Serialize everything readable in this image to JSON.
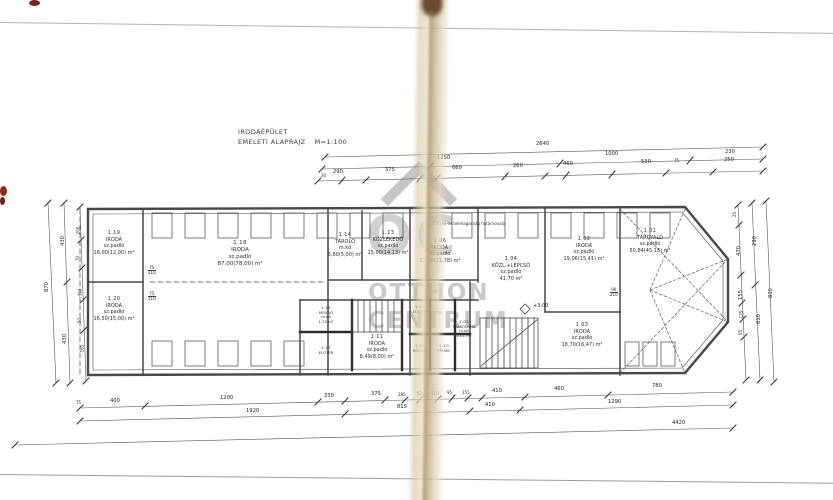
{
  "sheet": {
    "background": "#ffffff",
    "ink": "#474747",
    "crease_color": "#d5c5a6",
    "stain_color": "#7a241c",
    "watermark_color": "#c9c9c9"
  },
  "title": {
    "line1": "IRODAÉPÜLET",
    "line2": "EMELETI ALAPRAJZ",
    "scale": "M=1:100"
  },
  "watermark": {
    "logo": "OC",
    "line1": "OTTHON",
    "line2": "CENTRUM"
  },
  "plan": {
    "note": "1,90 m-es belmagasság határvonala",
    "level_mark": "+3,00",
    "door_marks": [
      {
        "w": "75",
        "h": "210"
      },
      {
        "w": "75",
        "h": "210"
      },
      {
        "w": "90",
        "h": "210"
      }
    ],
    "rooms": [
      {
        "number": "1.19",
        "name": "IRODA",
        "spec": "sz.padló",
        "area": "16,00(12,00) m²"
      },
      {
        "number": "1.20",
        "name": "IRODA",
        "spec": "sz.padló",
        "area": "16,50(15,00) m²"
      },
      {
        "number": "1.18",
        "name": "IRODA",
        "spec": "sz.padló",
        "area": "87,00(78,00) m²"
      },
      {
        "number": "1.14",
        "name": "TÁROLÓ",
        "spec": "m.kő",
        "area": "6,60(5,00) m²"
      },
      {
        "number": "1.13",
        "name": "KÖZLEKEDŐ",
        "spec": "sz.padló",
        "area": "15,00(14,13) m²"
      },
      {
        "number": "1.06",
        "name": "IRODA",
        "spec": "sz.padló",
        "area": "23,36(21,78) m²"
      },
      {
        "number": "1.04",
        "name": "KÖZL.+LÉPCSŐ",
        "spec": "sz.padló",
        "area": "41,70 m²"
      },
      {
        "number": "1.02",
        "name": "IRODA",
        "spec": "sz.padló",
        "area": "19,06(15,41) m²"
      },
      {
        "number": "1.01",
        "name": "TÁRGYALÓ",
        "spec": "sz.padló",
        "area": "50,84(45,15) m²"
      },
      {
        "number": "1.03",
        "name": "IRODA",
        "spec": "sz.padló",
        "area": "18,70(16,47) m²"
      },
      {
        "number": "1.11",
        "name": "IRODA",
        "spec": "sz.padló",
        "area": "8,49(8,00) m²"
      },
      {
        "number": "1.12",
        "name": "MOSDÓ",
        "spec": "m.kő",
        "area": "1,70 m²"
      },
      {
        "number": "1.05",
        "name": "TEAKONYHA",
        "spec": "m.kő",
        "area": "6,61 m²"
      },
      {
        "number": "1.07",
        "name": "ELŐTÉR",
        "spec": "m.kő",
        "area": ""
      },
      {
        "number": "1.09",
        "name": "NŐI WC",
        "spec": "m.kő",
        "area": ""
      },
      {
        "number": "1.10",
        "name": "FFI WC",
        "spec": "m.kő",
        "area": ""
      },
      {
        "number": "1.17",
        "name": "ELŐTÉR",
        "spec": "m.kő",
        "area": ""
      }
    ]
  },
  "dimensions": {
    "top_row1": [
      "2640"
    ],
    "top_row2": [
      "1250",
      "1000",
      "230"
    ],
    "top_row3": [
      "290",
      "375",
      "660",
      "260",
      "460",
      "530",
      "250"
    ],
    "top_small": [
      "30",
      "75",
      "75"
    ],
    "bottom_row1": [
      "75",
      "400",
      "1200",
      "330",
      "375",
      "185",
      "52",
      "110",
      "95",
      "155",
      "410",
      "460",
      "780"
    ],
    "bottom_row2": [
      "1920",
      "815",
      "410",
      "1290"
    ],
    "bottom_row3": [
      "4420"
    ],
    "left_outer": [
      "870"
    ],
    "left_mid": [
      "430",
      "430"
    ],
    "left_inner": [
      "200",
      "70",
      "310",
      "50",
      "165"
    ],
    "right_1": [
      "25",
      "470",
      "155",
      "125",
      "55"
    ],
    "right_2": [
      "290",
      "610"
    ],
    "right_3": [
      "835"
    ]
  }
}
